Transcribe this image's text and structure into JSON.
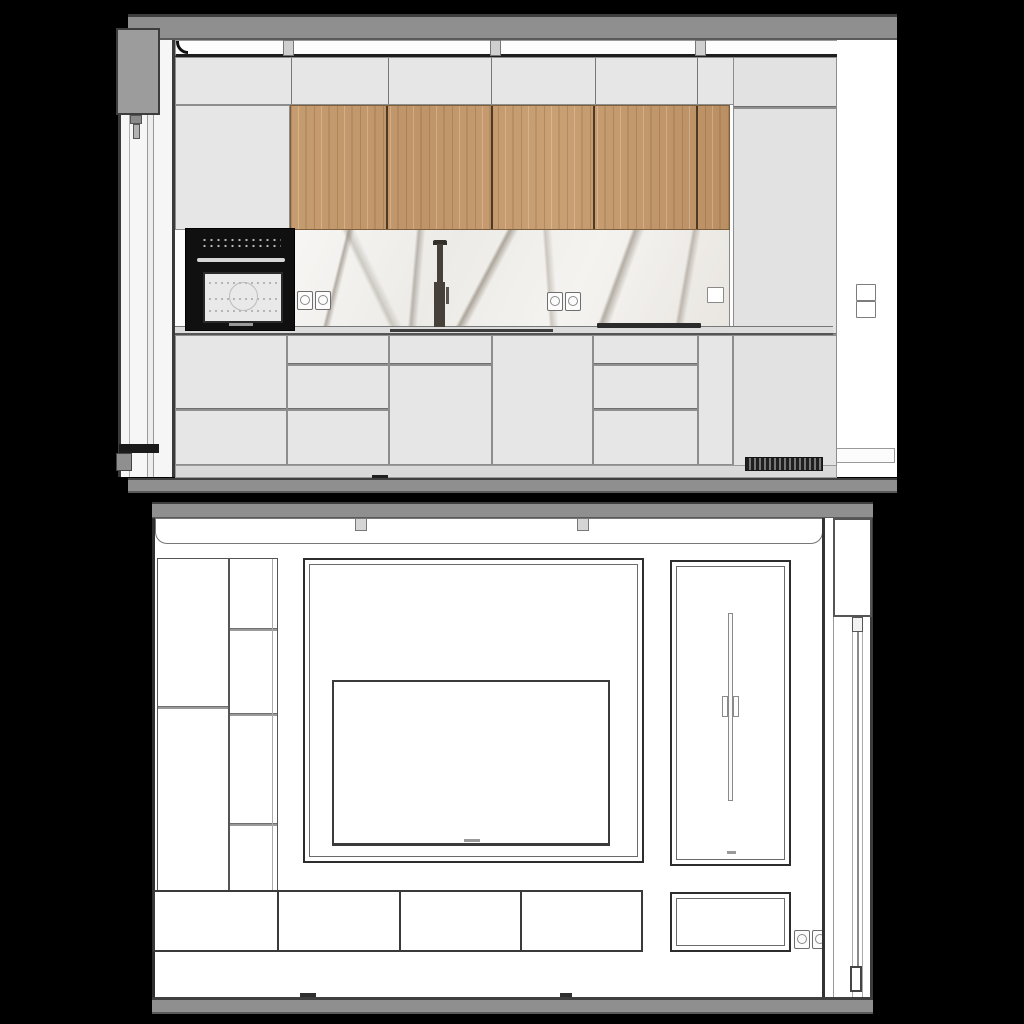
{
  "scene": {
    "description": "Two interior elevation drawings rendered on a black background",
    "views": [
      {
        "name": "kitchen-elevation",
        "placement": "top"
      },
      {
        "name": "media-wall-elevation",
        "placement": "bottom"
      }
    ]
  },
  "colors": {
    "background": "#000000",
    "ceiling_band": "#8f8f8f",
    "floor_band": "#8f8f8f",
    "cabinet_light": "#e5e5e5",
    "wood_front": "#c39a6d",
    "marble_base": "#f3f1ee",
    "marble_vein": "#8c8274",
    "oven_black": "#101010",
    "line_dark": "#333333",
    "line_mid": "#8a8a8a",
    "white_wall": "#ffffff"
  },
  "kitchen_elevation": {
    "upper_cabinet_panels": 8,
    "wood_cabinet_doors": 5,
    "oven": {
      "type": "built-in black oven",
      "window": true,
      "control_dots": true,
      "brand_mark": true
    },
    "backsplash": "white marble with gray veining",
    "faucet": "dark counter-mounted mixer tap",
    "double_sockets_on_backsplash": 2,
    "backsplash_switch": 1,
    "wall_switch_right_double": 1,
    "base_units": [
      "2-drawer stack",
      "3-drawer stack",
      "top drawer + door",
      "full door",
      "3-drawer stack",
      "narrow filler"
    ],
    "tall_cabinet_column_right": true,
    "plinth_vent_grille": true,
    "counter_inset_marks": [
      "sink",
      "cooktop"
    ],
    "window_left": {
      "roller_blind_box": true,
      "cord_weight": true,
      "bottom_handle": true
    }
  },
  "media_wall_elevation": {
    "left_wall_panels": 2,
    "open_shelf_compartments": 4,
    "tv_niche_framed": true,
    "tv": {
      "label_mark": true
    },
    "tall_door": {
      "vertical_rod_handle": true,
      "bottom_mark": true
    },
    "base_door_fronts": 4,
    "framed_base_panel": 1,
    "double_socket": 1,
    "cove_connector_tabs": 2,
    "window_right": {
      "roller_blind_box": true,
      "cord": true,
      "cord_lock": true,
      "cord_weight": true
    }
  }
}
